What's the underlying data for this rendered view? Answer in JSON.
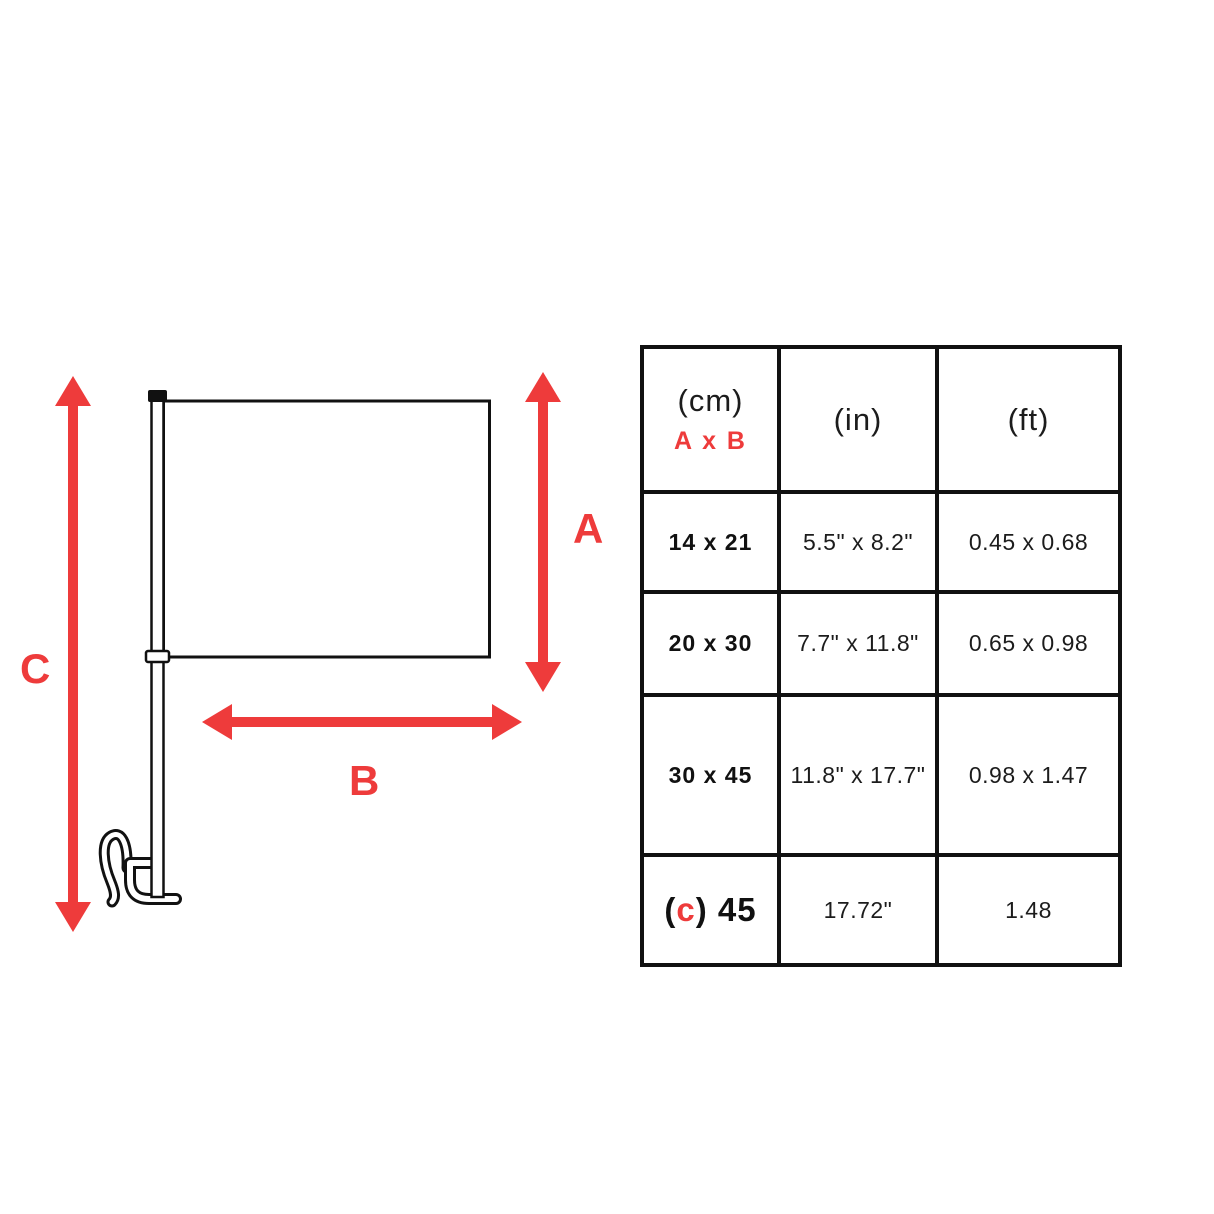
{
  "diagram": {
    "label_a": "A",
    "label_b": "B",
    "label_c": "C"
  },
  "table": {
    "header": {
      "cm_unit": "(cm)",
      "cm_formula": "A x B",
      "in_unit": "(in)",
      "ft_unit": "(ft)"
    },
    "rows": [
      {
        "cm": "14 x 21",
        "inches": "5.5\" x 8.2\"",
        "feet": "0.45 x 0.68"
      },
      {
        "cm": "20 x 30",
        "inches": "7.7\" x 11.8\"",
        "feet": "0.65 x 0.98"
      },
      {
        "cm": "30 x 45",
        "inches": "11.8\" x 17.7\"",
        "feet": "0.98 x 1.47"
      },
      {
        "cm_open": "(",
        "cm_c": "c",
        "cm_rest": ") 45",
        "inches": "17.72\"",
        "feet": "1.48"
      }
    ]
  },
  "colors": {
    "accent_red": "#ee3b3b",
    "line_black": "#111111"
  }
}
